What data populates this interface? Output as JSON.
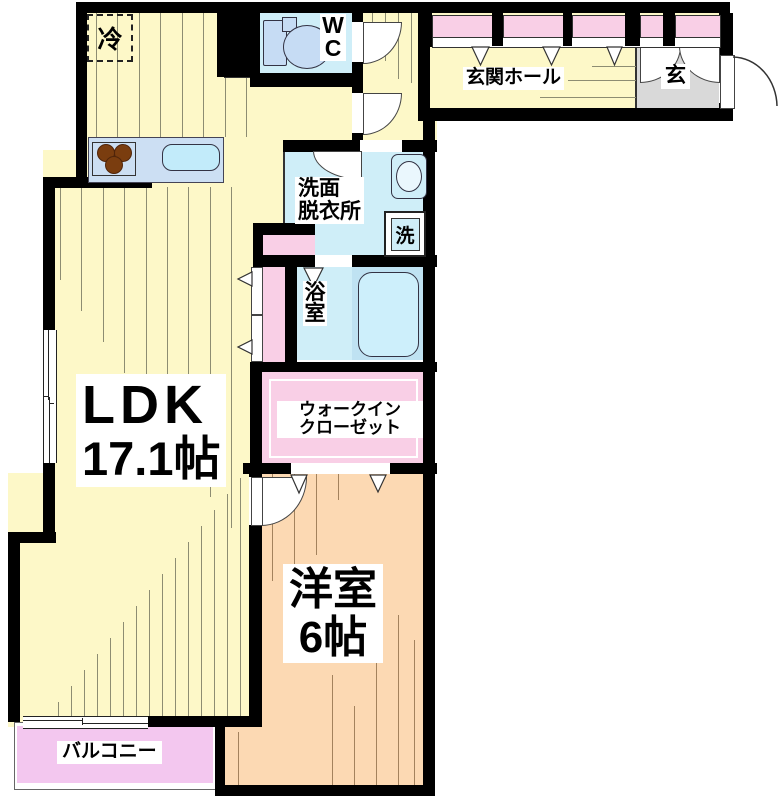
{
  "title": "floor-plan",
  "rooms": {
    "ldk": {
      "name": "LDK",
      "size": "17.1帖"
    },
    "yoshitsu": {
      "name": "洋室",
      "size": "6帖"
    },
    "senmen": {
      "line1": "洗面",
      "line2": "脱衣所"
    },
    "yokushitsu": {
      "name": "浴室"
    },
    "wic": {
      "line1": "ウォークイン",
      "line2": "クローゼット"
    },
    "hall": {
      "name": "玄関ホール"
    },
    "genkan": {
      "name": "玄"
    },
    "wc": {
      "name": "WC"
    },
    "balcony": {
      "name": "バルコニー"
    }
  },
  "fixtures": {
    "refrigerator": {
      "label": "冷"
    },
    "washer": {
      "label": "洗"
    }
  },
  "icons": {
    "toilet": "toilet-icon",
    "bathtub": "bathtub-icon",
    "stove": "stove-burners-icon",
    "kitchen_sink": "kitchen-sink-icon",
    "vanity_sink": "vanity-sink-icon",
    "door_swing": "door-swing-arc-icon",
    "opening_mark": "door-direction-triangle-icon"
  },
  "colors": {
    "wall": "#000000",
    "floor_yellow": "#fdf8c8",
    "room_peach": "#fcd9b3",
    "wet_blue": "#cfeef8",
    "tub_zone": "#bfe2f2",
    "tub": "#cdeffb",
    "counter_blue": "#ccdff3",
    "fixture_blue": "#c6dcf4",
    "closet_pink": "#f9cfe6",
    "balcony_lilac": "#f3c7ef",
    "genkan_gray": "#d9d9d9",
    "floor_line": "#8d8d72",
    "floor_line_peach": "#a3825d",
    "burner_brown": "#7a3d0f",
    "sink_cyan": "#c2ebfa"
  }
}
